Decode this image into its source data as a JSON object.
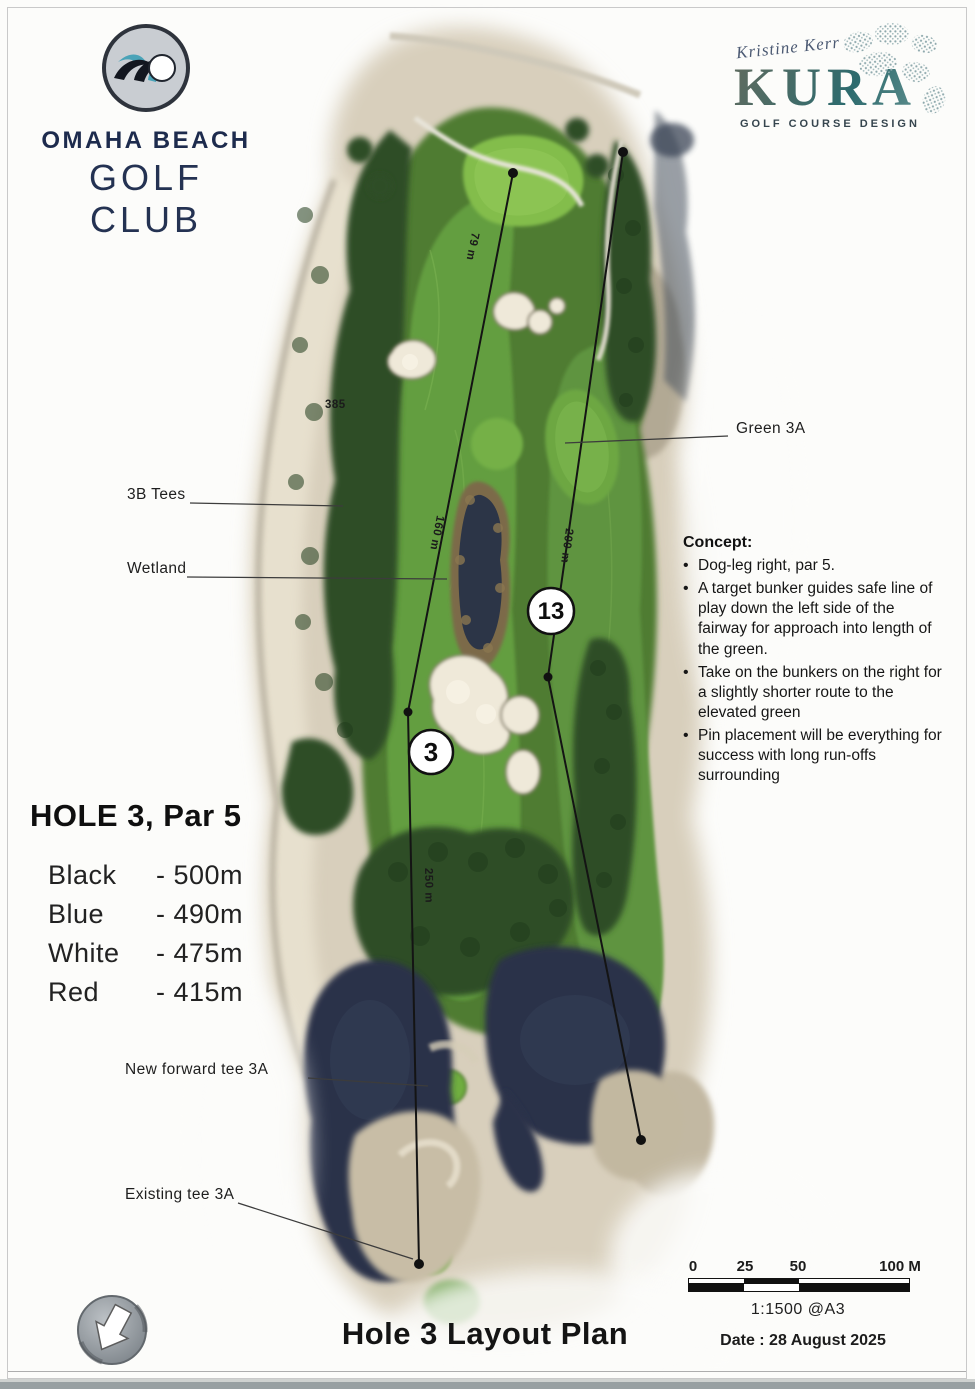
{
  "header": {
    "club": {
      "name_line1": "OMAHA BEACH",
      "name_line2": "GOLF CLUB"
    },
    "designer": {
      "signature": "Kristine Kerr",
      "brand": "KURA",
      "tagline": "GOLF COURSE DESIGN"
    }
  },
  "hole_info": {
    "title": "HOLE 3, Par 5",
    "tees": [
      {
        "name": "Black",
        "distance": "- 500m"
      },
      {
        "name": "Blue",
        "distance": "- 490m"
      },
      {
        "name": "White",
        "distance": "- 475m"
      },
      {
        "name": "Red",
        "distance": "- 415m"
      }
    ]
  },
  "concept": {
    "heading": "Concept:",
    "bullets": [
      "Dog-leg right, par 5.",
      "A target bunker guides safe line of play down the left side of the fairway for approach into length of the green.",
      "Take on the bunkers on the right for a slightly shorter route to the elevated green",
      "Pin placement will be everything for success with long run-offs surrounding"
    ]
  },
  "map": {
    "callouts": {
      "green_3a": "Green 3A",
      "tees_3b": "3B Tees",
      "wetland": "Wetland",
      "new_forward_tee": "New forward tee 3A",
      "existing_tee": "Existing tee 3A"
    },
    "hole_markers": {
      "hole_3": "3",
      "hole_13": "13"
    },
    "distance_labels": {
      "d79": "79 m",
      "d160": "160 m",
      "d200": "200 m",
      "d250": "250 m",
      "d385": "385"
    }
  },
  "footer": {
    "plan_title": "Hole 3 Layout Plan",
    "scale": {
      "ticks": [
        "0",
        "25",
        "50",
        "100 M"
      ],
      "ratio": "1:1500 @A3"
    },
    "date": "Date : 28 August 2025"
  },
  "colors": {
    "club_navy": "#1d2b4d",
    "kura_teal": "#2e686c",
    "fairway_green": "#649e41",
    "bright_green": "#83bd4b",
    "tree_green": "#2f4d28",
    "water_navy": "#29324a",
    "sand": "#d8cfbc"
  }
}
